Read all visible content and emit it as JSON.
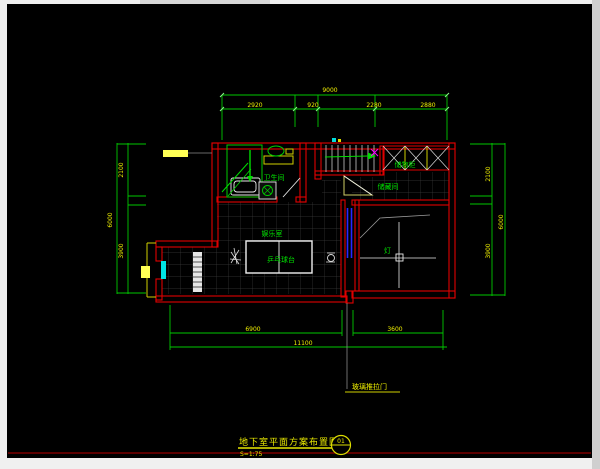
{
  "window": {
    "canvas_bg": "#000000",
    "frame_color": "#f0f0f0"
  },
  "palette": {
    "wall_red": "#e00000",
    "frame_dark_red": "#7a0000",
    "dim_green": "#00c800",
    "label_green": "#00e000",
    "text_yellow": "#f0f000",
    "highlight_yellow": "#ffff55",
    "window_cyan": "#00e5e5",
    "door_blue": "#2828ff",
    "fixture_white": "#ffffff",
    "grid_gray": "#3a3a3a",
    "magenta_marker": "#ff00ff"
  },
  "title_block": {
    "title": "地下室平面方案布置图",
    "scale": "S=1:75",
    "bubble_top": "01"
  },
  "rooms": {
    "bathroom": "卫生间",
    "cabinet": "储物柜",
    "under_stair_storage": "储藏间",
    "hall": "娱乐室",
    "table": "乒乓球台",
    "lamp": "灯"
  },
  "annotations": {
    "door_leader": "玻璃推拉门",
    "stair_up": "上"
  },
  "dimensions": {
    "top": {
      "overall": "9000",
      "segments": [
        "2920",
        "920",
        "2280",
        "2880"
      ]
    },
    "left": {
      "overall": "6000",
      "segments": [
        "2100",
        "3900"
      ]
    },
    "right": {
      "overall": "6000",
      "segments": [
        "2100",
        "3900"
      ]
    },
    "bottom": {
      "overall": "11100",
      "segments": [
        "6900",
        "3600"
      ]
    }
  }
}
